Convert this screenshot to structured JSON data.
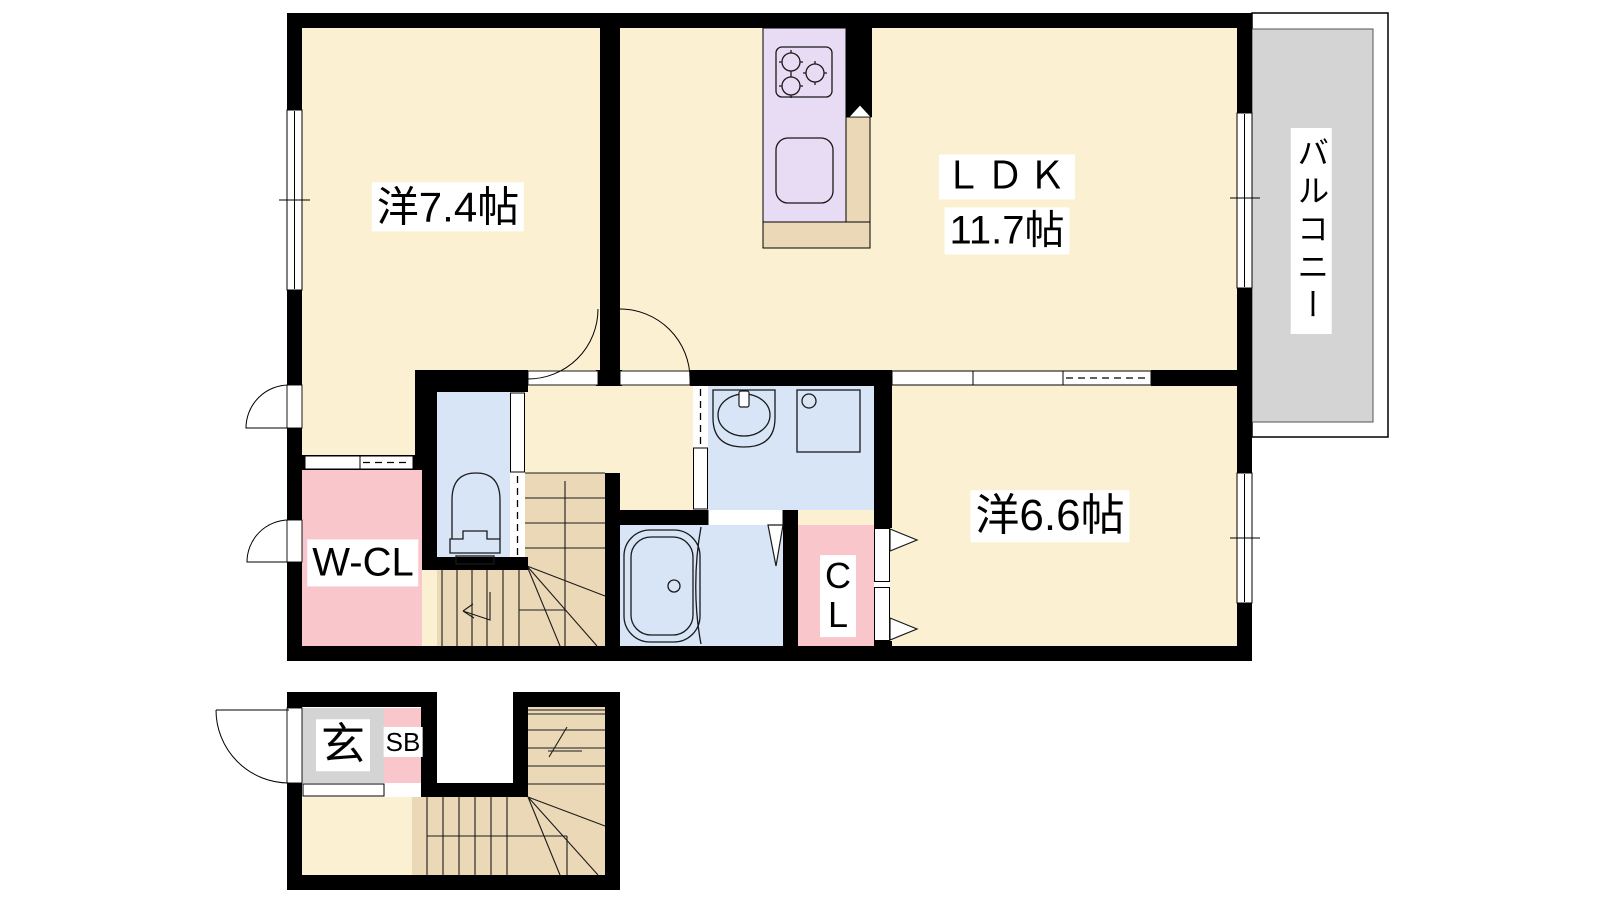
{
  "floorplan": {
    "floor2": {
      "rooms": [
        {
          "id": "western-room-1",
          "label": "洋7.4帖"
        },
        {
          "id": "ldk",
          "label": "ＬＤＫ",
          "size": "11.7帖"
        },
        {
          "id": "western-room-2",
          "label": "洋6.6帖"
        },
        {
          "id": "walk-in-closet",
          "label": "W-CL"
        },
        {
          "id": "closet",
          "label": "C\nL"
        },
        {
          "id": "balcony",
          "label": "バルコニー"
        }
      ]
    },
    "floor1": {
      "rooms": [
        {
          "id": "entrance",
          "label": "玄"
        },
        {
          "id": "shoe-box",
          "label": "SB"
        }
      ]
    },
    "colors": {
      "wall": "#000000",
      "cream": "#FCF0D3",
      "blue": "#D7E5F7",
      "pink": "#F9C6CC",
      "tan": "#EBD8B6",
      "lav": "#E7DCF3",
      "gray": "#D4D4D4"
    }
  }
}
